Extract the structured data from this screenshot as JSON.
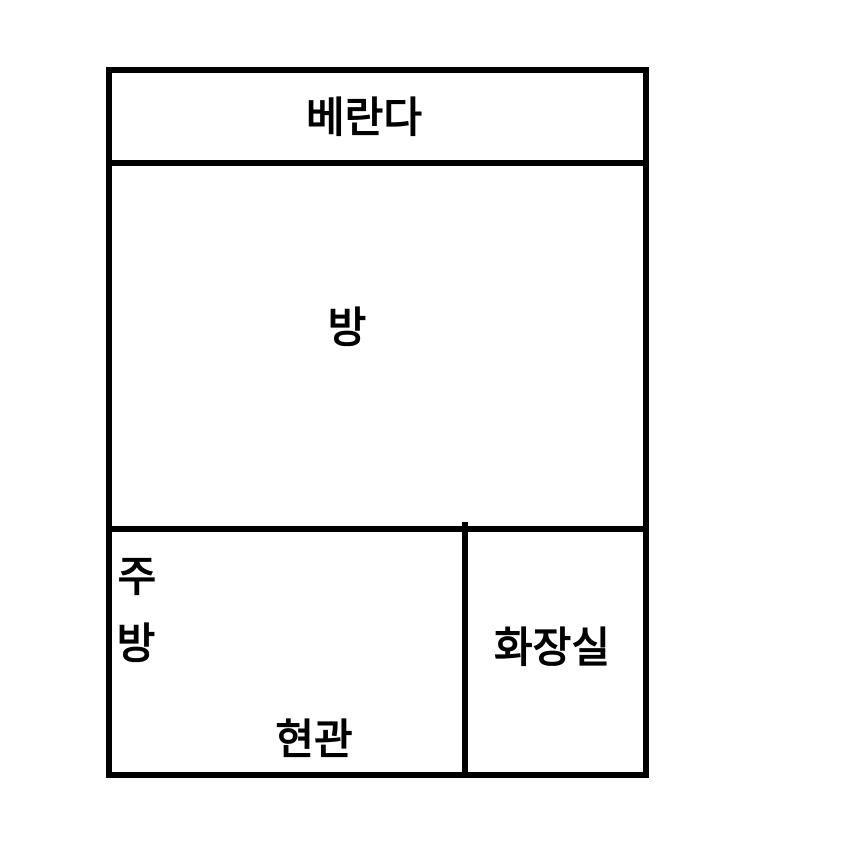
{
  "page": {
    "type": "floor-plan-drawing",
    "colors": {
      "background": "#ffffff",
      "wall": "#000000",
      "text": "#000000"
    }
  },
  "rooms": {
    "veranda": {
      "label": "베란다"
    },
    "room": {
      "label": "방"
    },
    "kitchen": {
      "line1": "주",
      "line2": "방"
    },
    "entrance": {
      "label": "현관"
    },
    "bathroom": {
      "label": "화장실"
    }
  }
}
